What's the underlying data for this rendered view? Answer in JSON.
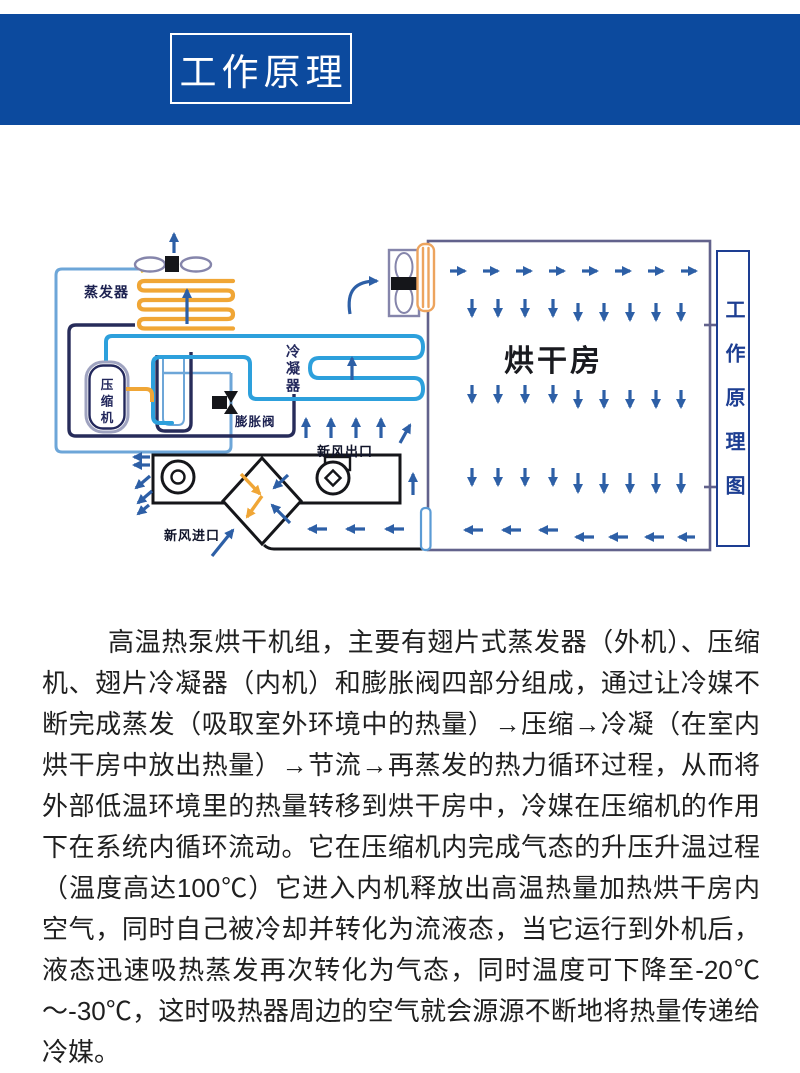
{
  "header": {
    "title": "工作原理"
  },
  "diagram": {
    "side_caption": "工作原理图",
    "labels": {
      "evaporator": "蒸发器",
      "compressor": "压缩机",
      "expansion_valve": "膨胀阀",
      "condenser": "冷凝器",
      "drying_room": "烘干房",
      "fresh_air_outlet": "新风出口",
      "fresh_air_inlet": "新风进口"
    },
    "colors": {
      "band_blue": "#0c4a9e",
      "pipe_dark_navy": "#272c5a",
      "pipe_light_blue": "#6da6d8",
      "condenser_cyan": "#2da0dc",
      "coil_orange": "#f0a636",
      "indoor_coil_orange": "#eda45e",
      "arrow_navy": "#2d5fa6",
      "caption_navy": "#1d3e92",
      "fan_gray": "#8585ab",
      "room_border": "#62628c",
      "unit_black": "#15161a"
    }
  },
  "body": {
    "paragraph": "高温热泵烘干机组，主要有翅片式蒸发器（外机）、压缩机、翅片冷凝器（内机）和膨胀阀四部分组成，通过让冷媒不断完成蒸发（吸取室外环境中的热量）→压缩→冷凝（在室内烘干房中放出热量）→节流→再蒸发的热力循环过程，从而将外部低温环境里的热量转移到烘干房中，冷媒在压缩机的作用下在系统内循环流动。它在压缩机内完成气态的升压升温过程（温度高达100℃）它进入内机释放出高温热量加热烘干房内空气，同时自己被冷却并转化为流液态，当它运行到外机后，液态迅速吸热蒸发再次转化为气态，同时温度可下降至-20℃～-30℃，这时吸热器周边的空气就会源源不断地将热量传递给冷媒。"
  }
}
